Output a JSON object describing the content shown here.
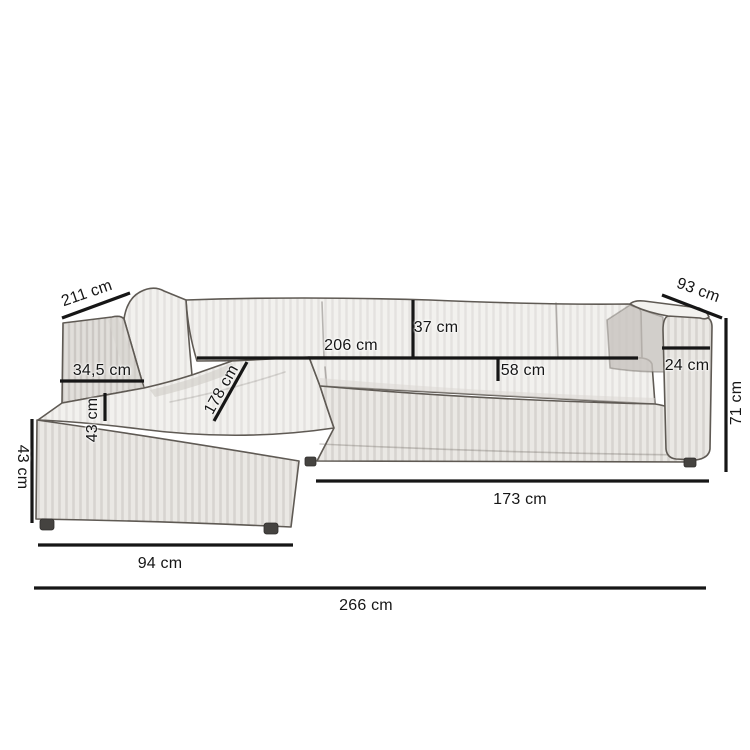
{
  "illustration": {
    "subject": "corner-sofa-sketch",
    "style": "hand-drawn pencil sketch, three-quarter view, chaise on left",
    "background_color": "#ffffff",
    "dimension_line_color": "#161616",
    "sketch_outline_color": "#5f5a54",
    "upholstery_color": "#f2f1ee"
  },
  "dimensions": {
    "d211": {
      "label": "211 cm",
      "value": 211,
      "unit": "cm",
      "orientation": "diagonal-back-left"
    },
    "d345": {
      "label": "34,5 cm",
      "value": 34.5,
      "unit": "cm",
      "orientation": "horizontal"
    },
    "d43seat": {
      "label": "43 cm",
      "value": 43,
      "unit": "cm",
      "orientation": "vertical"
    },
    "d43height": {
      "label": "43 cm",
      "value": 43,
      "unit": "cm",
      "orientation": "vertical"
    },
    "d178": {
      "label": "178 cm",
      "value": 178,
      "unit": "cm",
      "orientation": "diagonal-chaise"
    },
    "d206": {
      "label": "206 cm",
      "value": 206,
      "unit": "cm",
      "orientation": "horizontal"
    },
    "d37": {
      "label": "37 cm",
      "value": 37,
      "unit": "cm",
      "orientation": "vertical"
    },
    "d58": {
      "label": "58 cm",
      "value": 58,
      "unit": "cm",
      "orientation": "horizontal"
    },
    "d93": {
      "label": "93 cm",
      "value": 93,
      "unit": "cm",
      "orientation": "diagonal-back-right"
    },
    "d24": {
      "label": "24 cm",
      "value": 24,
      "unit": "cm",
      "orientation": "horizontal"
    },
    "d71": {
      "label": "71 cm",
      "value": 71,
      "unit": "cm",
      "orientation": "vertical"
    },
    "d173": {
      "label": "173 cm",
      "value": 173,
      "unit": "cm",
      "orientation": "horizontal"
    },
    "d94": {
      "label": "94 cm",
      "value": 94,
      "unit": "cm",
      "orientation": "horizontal"
    },
    "d266": {
      "label": "266 cm",
      "value": 266,
      "unit": "cm",
      "orientation": "horizontal"
    }
  }
}
